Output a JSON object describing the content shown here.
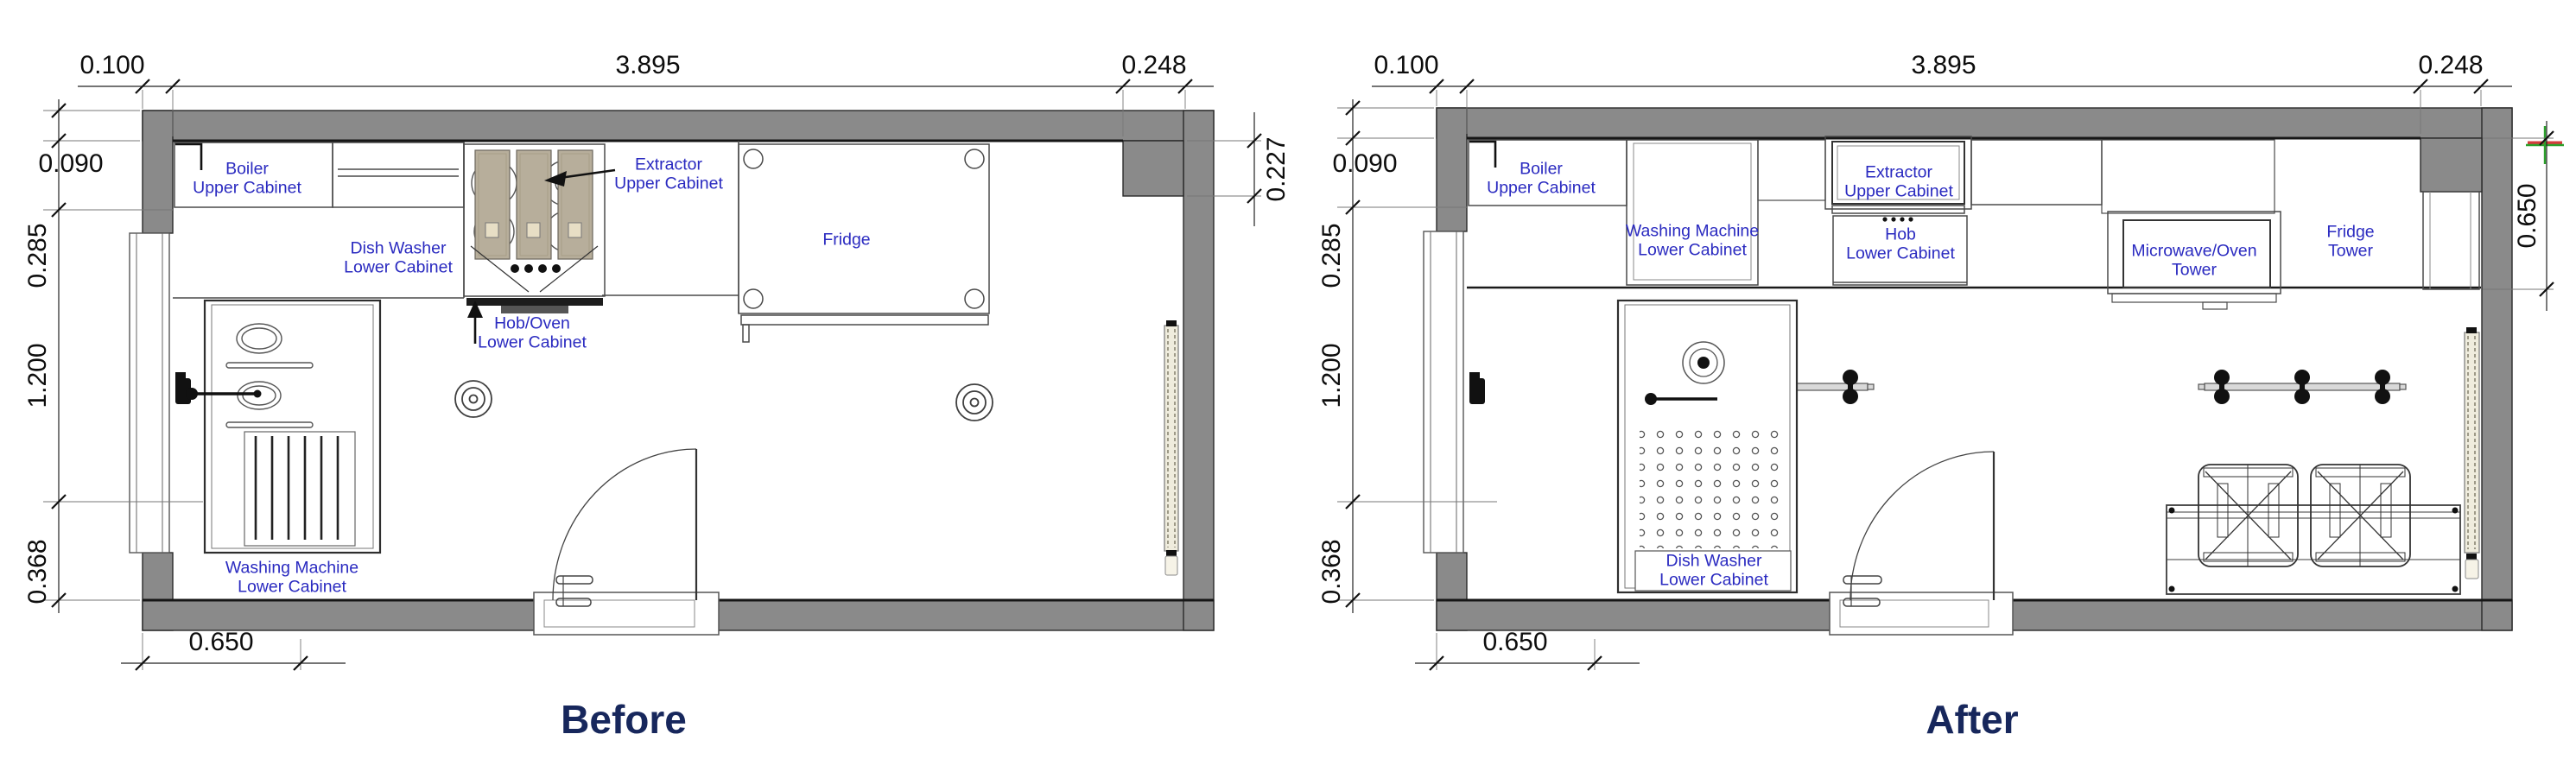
{
  "document": {
    "type": "kitchen floor plan comparison drawing",
    "background": "#ffffff"
  },
  "colors": {
    "wall_fill": "#8a8a8a",
    "wall_stroke": "#2a2a2a",
    "label_blue": "#2a2ac0",
    "title_navy": "#17275c",
    "dim_text": "#0d0d0d",
    "extractor_tan": "#b7ae9b",
    "radiator_cream": "#efecdd",
    "marker_green": "#2ca02c",
    "marker_red": "#d43c3c"
  },
  "before": {
    "title": "Before",
    "dims": {
      "top_left": "0.100",
      "top_span": "3.895",
      "top_right": "0.248",
      "left_1": "0.090",
      "left_2": "0.285",
      "left_3": "1.200",
      "left_4": "0.368",
      "right_1": "0.227",
      "bottom_1": "0.650"
    },
    "labels": {
      "boiler": "Boiler\nUpper Cabinet",
      "dish_washer": "Dish Washer\nLower Cabinet",
      "extractor": "Extractor\nUpper Cabinet",
      "hob_oven": "Hob/Oven\nLower Cabinet",
      "fridge": "Fridge",
      "washing_machine": "Washing Machine\nLower Cabinet"
    }
  },
  "after": {
    "title": "After",
    "dims": {
      "top_left": "0.100",
      "top_span": "3.895",
      "top_right": "0.248",
      "left_1": "0.090",
      "left_2": "0.285",
      "left_3": "1.200",
      "left_4": "0.368",
      "right_1": "0.650",
      "bottom_1": "0.650"
    },
    "labels": {
      "boiler": "Boiler\nUpper Cabinet",
      "washing_machine": "Washing Machine\nLower Cabinet",
      "extractor": "Extractor\nUpper Cabinet",
      "hob": "Hob\nLower Cabinet",
      "microwave_oven": "Microwave/Oven\nTower",
      "fridge_tower": "Fridge\nTower",
      "dish_washer": "Dish Washer\nLower Cabinet"
    }
  }
}
